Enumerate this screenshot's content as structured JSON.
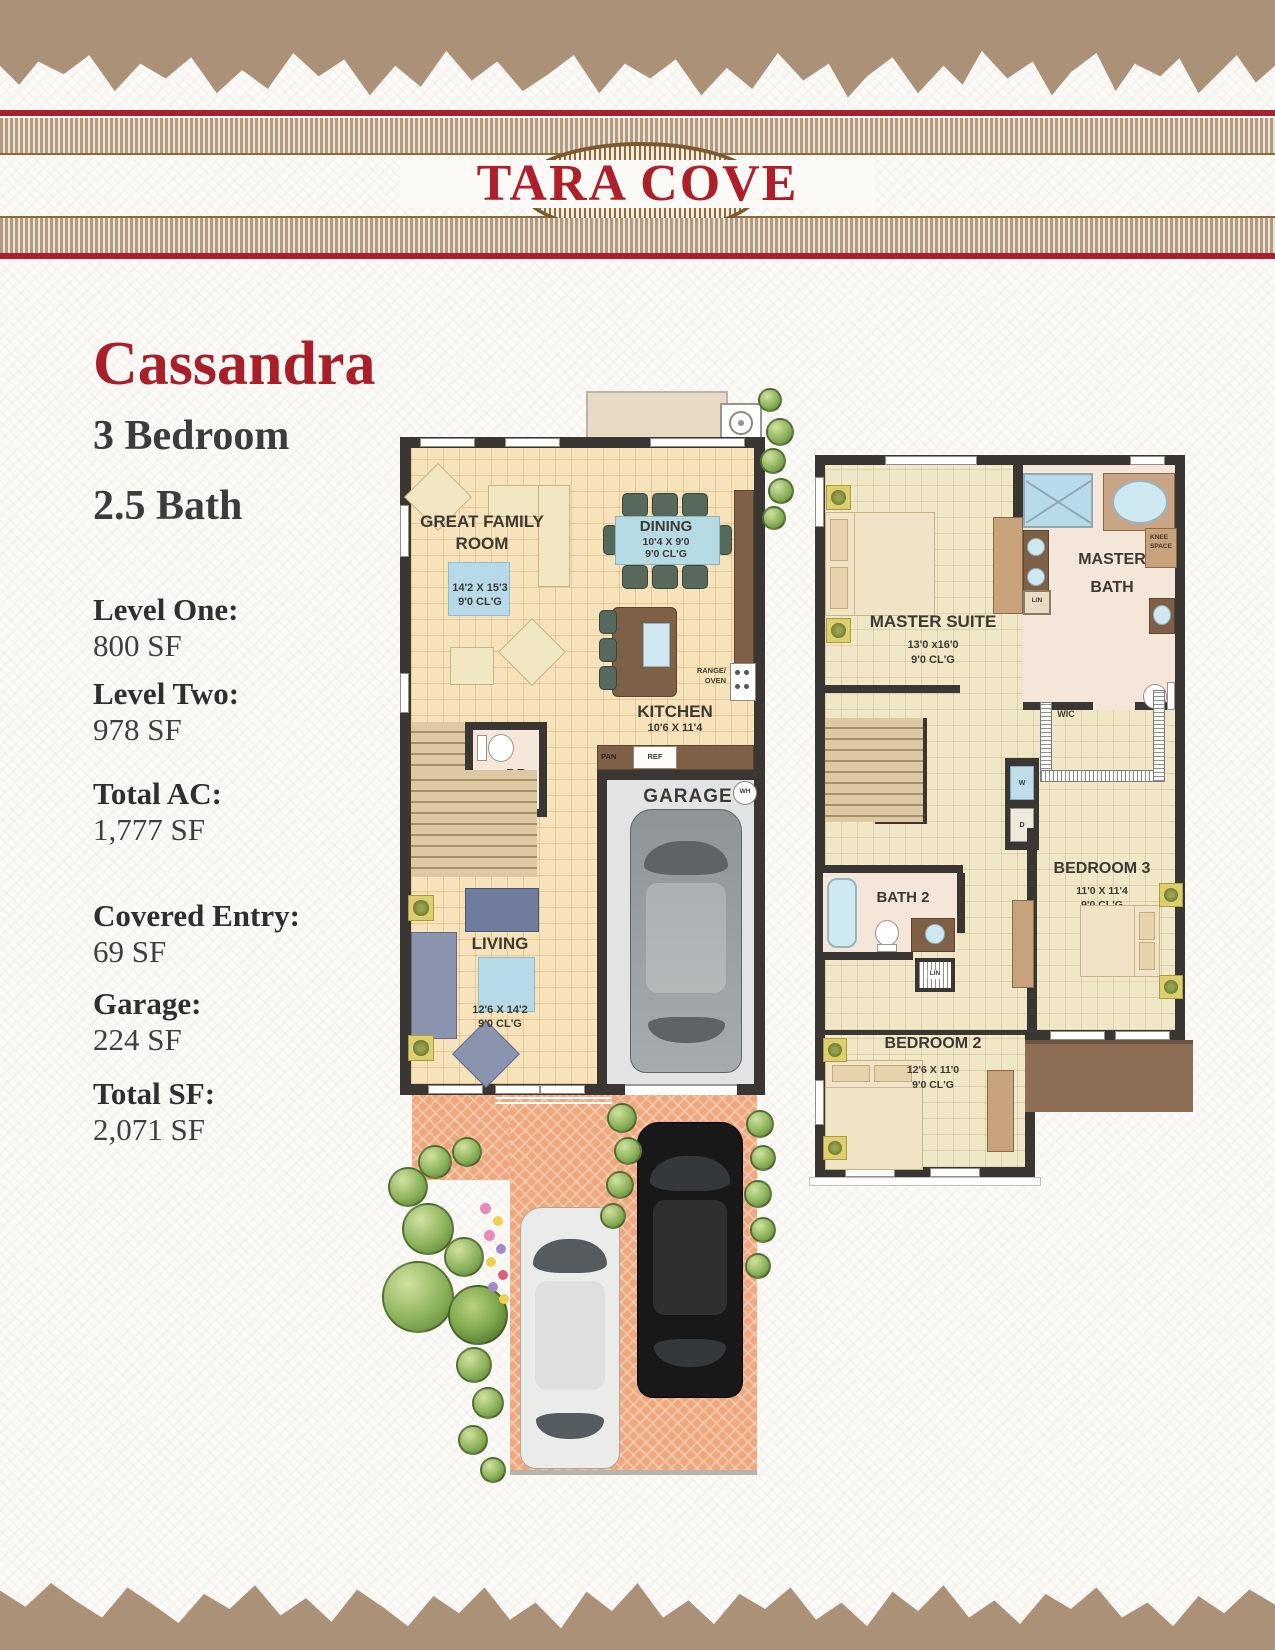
{
  "header": {
    "community_name": "TARA COVE"
  },
  "model": {
    "name": "Cassandra",
    "bedrooms": "3 Bedroom",
    "baths": "2.5 Bath"
  },
  "stats": [
    {
      "label": "Level One:",
      "value": "800 SF"
    },
    {
      "label": "Level Two:",
      "value": "978 SF"
    },
    {
      "label": "Total AC:",
      "value": "1,777 SF"
    },
    {
      "label": "Covered Entry:",
      "value": "69 SF"
    },
    {
      "label": "Garage:",
      "value": "224 SF"
    },
    {
      "label": "Total SF:",
      "value": "2,071 SF"
    }
  ],
  "level1": {
    "rooms": {
      "great_family_room": {
        "name_line1": "GREAT FAMILY",
        "name_line2": "ROOM",
        "dims": "14'2 X 15'3",
        "clg": "9'0 CL'G"
      },
      "dining": {
        "name": "DINING",
        "dims": "10'4 X 9'0",
        "clg": "9'0 CL'G"
      },
      "kitchen": {
        "name": "KITCHEN",
        "dims": "10'6 X 11'4"
      },
      "powder_room": {
        "name": "P.R."
      },
      "garage": {
        "name": "GARAGE",
        "dims": "10'6 x 20'0"
      },
      "living": {
        "name": "LIVING",
        "dims": "12'6 X 14'2",
        "clg": "9'0 CL'G"
      }
    },
    "labels": {
      "ac_comp": "A/C COMP",
      "range_line1": "RANGE/",
      "range_line2": "OVEN",
      "pantry": "PAN",
      "refrigerator": "REF",
      "water_heater": "WH"
    }
  },
  "level2": {
    "rooms": {
      "master_suite": {
        "name": "MASTER SUITE",
        "dims": "13'0 x16'0",
        "clg": "9'0 CL'G"
      },
      "master_bath": {
        "name_line1": "MASTER",
        "name_line2": "BATH"
      },
      "wic": {
        "name": "WIC"
      },
      "bath2": {
        "name": "BATH 2"
      },
      "bedroom2": {
        "name": "BEDROOM 2",
        "dims": "12'6 X 11'0",
        "clg": "9'0 CL'G"
      },
      "bedroom3": {
        "name": "BEDROOM 3",
        "dims": "11'0 X 11'4",
        "clg": "9'0 CL'G"
      }
    },
    "labels": {
      "linen1": "LIN",
      "linen2": "LIN",
      "knee_line1": "KNEE",
      "knee_line2": "SPACE",
      "ahu": "AHU",
      "washer": "W",
      "dryer": "D"
    }
  },
  "colors": {
    "brand_red": "#a42230",
    "band_tan": "#b29a7e",
    "torn_tan": "#ab9178",
    "wall": "#3a3633",
    "floor_level1": "#f7e3bb",
    "floor_level2": "#efe7c6",
    "bath_floor": "#f4e7da",
    "driveway": "#efa87d",
    "counter_brown": "#7d6045",
    "roof_brown": "#8d6e54"
  }
}
